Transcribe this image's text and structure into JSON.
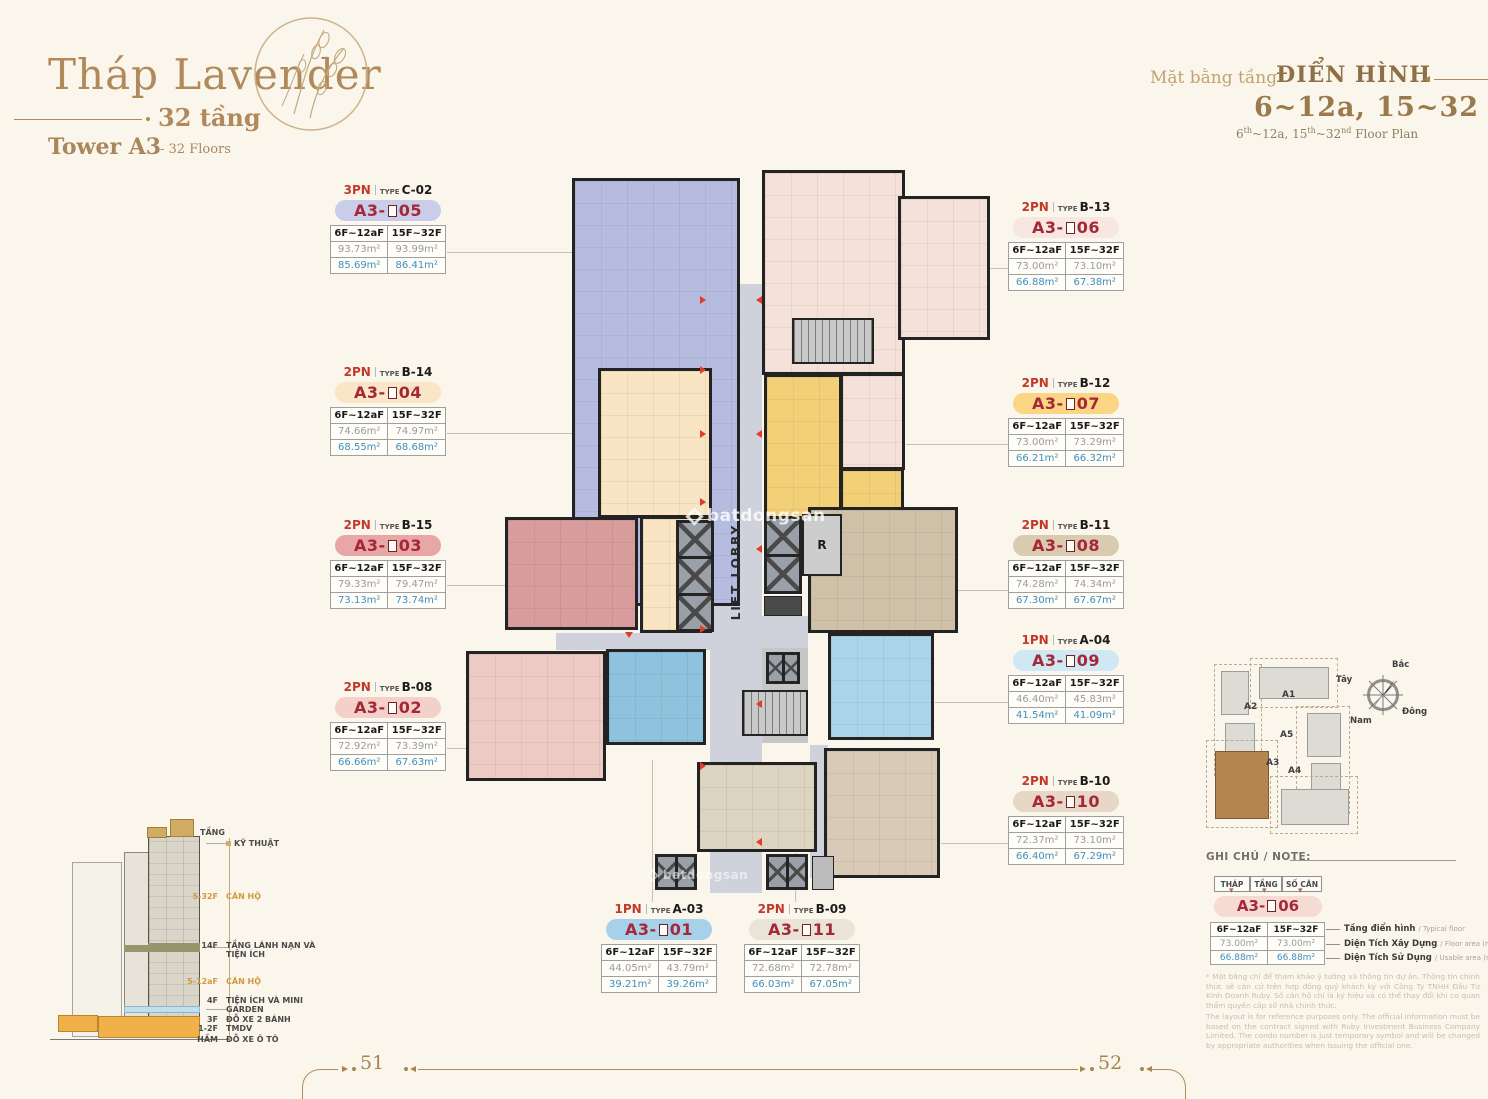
{
  "theme": {
    "bg": "#fbf6ec",
    "gold": "#b08a5a",
    "red": "#a42837",
    "pn_red": "#c0392b",
    "blue_area": "#3e8fc0",
    "gray_area": "#9a9a9a"
  },
  "header": {
    "title": "Tháp Lavender",
    "floors": "32 tầng",
    "tower": "Tower A3",
    "tower_suffix": "- 32 Floors"
  },
  "plan_header": {
    "vi_light": "Mặt bằng tầng",
    "vi_bold": "ĐIỂN HÌNH",
    "range": "6~12a, 15~32",
    "en": {
      "p1": "6",
      "s1": "th",
      "p2": "~12a, 15",
      "s2": "th",
      "p3": "~32",
      "s3": "nd",
      "p4": " Floor Plan"
    }
  },
  "labels": {
    "type_word": "TYPE",
    "prefix": "A3-",
    "col1": "6F~12aF",
    "col2": "15F~32F"
  },
  "units": [
    {
      "id": "a305",
      "pn": "3PN",
      "type": "C-02",
      "num": "05",
      "pill": "#c9cde9",
      "areas_top": [
        "93.73m²",
        "93.99m²"
      ],
      "areas_bot": [
        "85.69m²",
        "86.41m²"
      ]
    },
    {
      "id": "a304",
      "pn": "2PN",
      "type": "B-14",
      "num": "04",
      "pill": "#fbe5c7",
      "areas_top": [
        "74.66m²",
        "74.97m²"
      ],
      "areas_bot": [
        "68.55m²",
        "68.68m²"
      ]
    },
    {
      "id": "a303",
      "pn": "2PN",
      "type": "B-15",
      "num": "03",
      "pill": "#e8a6a6",
      "areas_top": [
        "79.33m²",
        "79.47m²"
      ],
      "areas_bot": [
        "73.13m²",
        "73.74m²"
      ]
    },
    {
      "id": "a302",
      "pn": "2PN",
      "type": "B-08",
      "num": "02",
      "pill": "#f4d0ca",
      "areas_top": [
        "72.92m²",
        "73.39m²"
      ],
      "areas_bot": [
        "66.66m²",
        "67.63m²"
      ]
    },
    {
      "id": "a306",
      "pn": "2PN",
      "type": "B-13",
      "num": "06",
      "pill": "#f8e7e1",
      "areas_top": [
        "73.00m²",
        "73.10m²"
      ],
      "areas_bot": [
        "66.88m²",
        "67.38m²"
      ]
    },
    {
      "id": "a307",
      "pn": "2PN",
      "type": "B-12",
      "num": "07",
      "pill": "#fbd584",
      "areas_top": [
        "73.00m²",
        "73.29m²"
      ],
      "areas_bot": [
        "66.21m²",
        "66.32m²"
      ]
    },
    {
      "id": "a308",
      "pn": "2PN",
      "type": "B-11",
      "num": "08",
      "pill": "#d9cab0",
      "areas_top": [
        "74.28m²",
        "74.34m²"
      ],
      "areas_bot": [
        "67.30m²",
        "67.67m²"
      ]
    },
    {
      "id": "a309",
      "pn": "1PN",
      "type": "A-04",
      "num": "09",
      "pill": "#cfe8f4",
      "areas_top": [
        "46.40m²",
        "45.83m²"
      ],
      "areas_bot": [
        "41.54m²",
        "41.09m²"
      ]
    },
    {
      "id": "a310",
      "pn": "2PN",
      "type": "B-10",
      "num": "10",
      "pill": "#e8d7c6",
      "areas_top": [
        "72.37m²",
        "73.10m²"
      ],
      "areas_bot": [
        "66.40m²",
        "67.29m²"
      ]
    },
    {
      "id": "a301",
      "pn": "1PN",
      "type": "A-03",
      "num": "01",
      "pill": "#a7d0e9",
      "areas_top": [
        "44.05m²",
        "43.79m²"
      ],
      "areas_bot": [
        "39.21m²",
        "39.26m²"
      ]
    },
    {
      "id": "a311",
      "pn": "2PN",
      "type": "B-09",
      "num": "11",
      "pill": "#eae3d8",
      "areas_top": [
        "72.68m²",
        "72.78m²"
      ],
      "areas_bot": [
        "66.03m²",
        "67.05m²"
      ]
    }
  ],
  "plan": {
    "lift_lobby": "LIFT LOBBY",
    "r": "R",
    "colors": {
      "c02": "#b6bcdf",
      "b13": "#f4e1da",
      "b14": "#f9e5c4",
      "b12": "#f2d078",
      "b15": "#d89c9c",
      "b08": "#eecac5",
      "a03": "#8fc3dd",
      "b11": "#cfc1a7",
      "a04": "#aad5e9",
      "b09": "#ddd5c1",
      "b10": "#d9c9b7",
      "corridor": "#cfd2db",
      "core": "#c6c6c6"
    }
  },
  "watermark": "batdongsan",
  "section_diagram": {
    "tang": "TẦNG",
    "rows": [
      {
        "floor": "",
        "name": "KỸ THUẬT"
      },
      {
        "floor": "5-32F",
        "name": "CĂN HỘ",
        "gold": true
      },
      {
        "floor": "14F",
        "name": "TẦNG LÁNH NẠN VÀ TIỆN ÍCH"
      },
      {
        "floor": "5-12aF",
        "name": "CĂN HỘ",
        "gold": true
      },
      {
        "floor": "4F",
        "name": "TIỆN ÍCH VÀ MINI GARDEN"
      },
      {
        "floor": "3F",
        "name": "ĐỖ XE 2 BÁNH"
      },
      {
        "floor": "1-2F",
        "name": "TMDV"
      },
      {
        "floor": "HẦM",
        "name": "ĐỖ XE Ô TÔ"
      }
    ]
  },
  "site_map": {
    "towers": {
      "a1": "A1",
      "a2": "A2",
      "a3": "A3",
      "a4": "A4",
      "a5": "A5"
    },
    "compass": {
      "n": "Bắc",
      "s": "Nam",
      "w": "Tây",
      "e": "Đông"
    }
  },
  "note": {
    "title": "GHI CHÚ / NOTE:",
    "legend_headers": [
      "THÁP",
      "TẦNG",
      "SỐ CĂN"
    ],
    "pill_num": "06",
    "pill_color": "#f6dbd5",
    "sample_rows": [
      [
        "73.00m²",
        "73.00m²"
      ],
      [
        "66.88m²",
        "66.88m²"
      ]
    ],
    "row_labels": [
      {
        "vi": "Tầng điển hình",
        "en": "/ Typical floor"
      },
      {
        "vi": "Diện Tích Xây Dựng",
        "en": "/ Floor area (m²)"
      },
      {
        "vi": "Diện Tích Sử Dụng",
        "en": "/ Usable area (m²)"
      }
    ],
    "disclaimer_vi": "* Mặt bằng chỉ để tham khảo ý tưởng và thông tin dự án. Thông tin chính thức sẽ căn cứ trên hợp đồng quý khách ký với Công Ty TNHH Đầu Tư Kinh Doanh Ruby. Số căn hộ chỉ là ký hiệu và có thể thay đổi khi cơ quan thẩm quyền cấp số nhà chính thức.",
    "disclaimer_en": "The layout is for reference purposes only. The official information must be based on the contract signed with Ruby Investment Business Company Limited. The condo number is just temporary symbol and will be changed by appropriate authorities when issuing the official one."
  },
  "footer": {
    "page_left": "51",
    "page_right": "52"
  }
}
